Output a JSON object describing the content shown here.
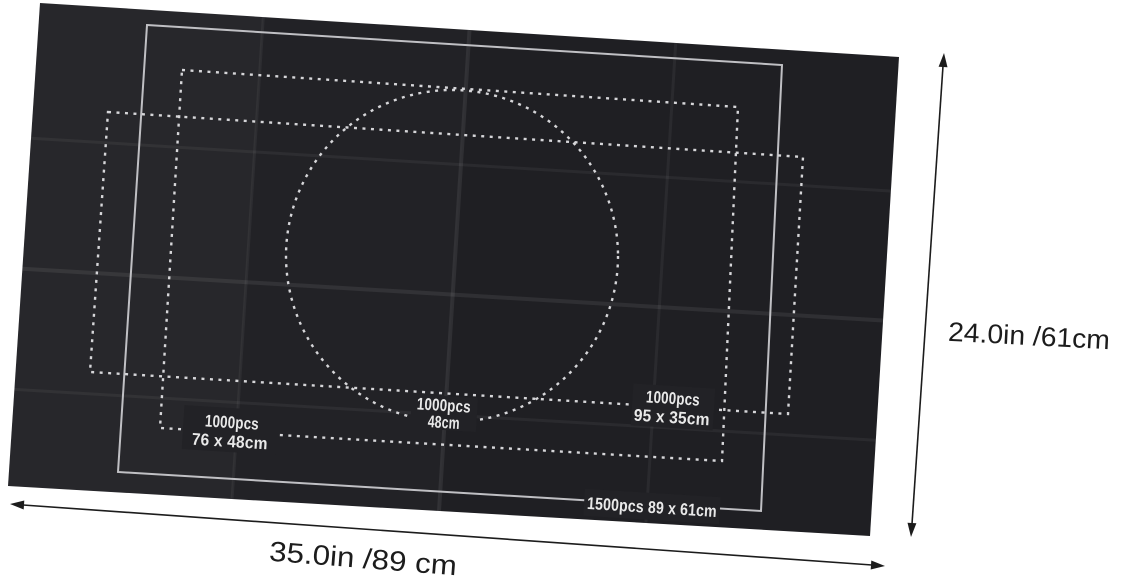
{
  "colors": {
    "background": "#ffffff",
    "mat": "#222226",
    "solid_outline": "#c0c0c4",
    "dotted_outline": "#d6d6d9",
    "mat_label_text": "#e9e9e9",
    "dimension_ink": "#1c1c1c"
  },
  "mat_markings": {
    "outline_1500": {
      "text": "1500pcs 89 x 61cm"
    },
    "rect_76x48": {
      "line1": "1000pcs",
      "line2": "76 x 48cm"
    },
    "circle_48": {
      "line1": "1000pcs",
      "line2": "48cm"
    },
    "rect_95x35": {
      "line1": "1000pcs",
      "line2": "95 x 35cm"
    }
  },
  "dimensions": {
    "height_label": "24.0in /61cm",
    "width_label": "35.0in /89 cm"
  }
}
